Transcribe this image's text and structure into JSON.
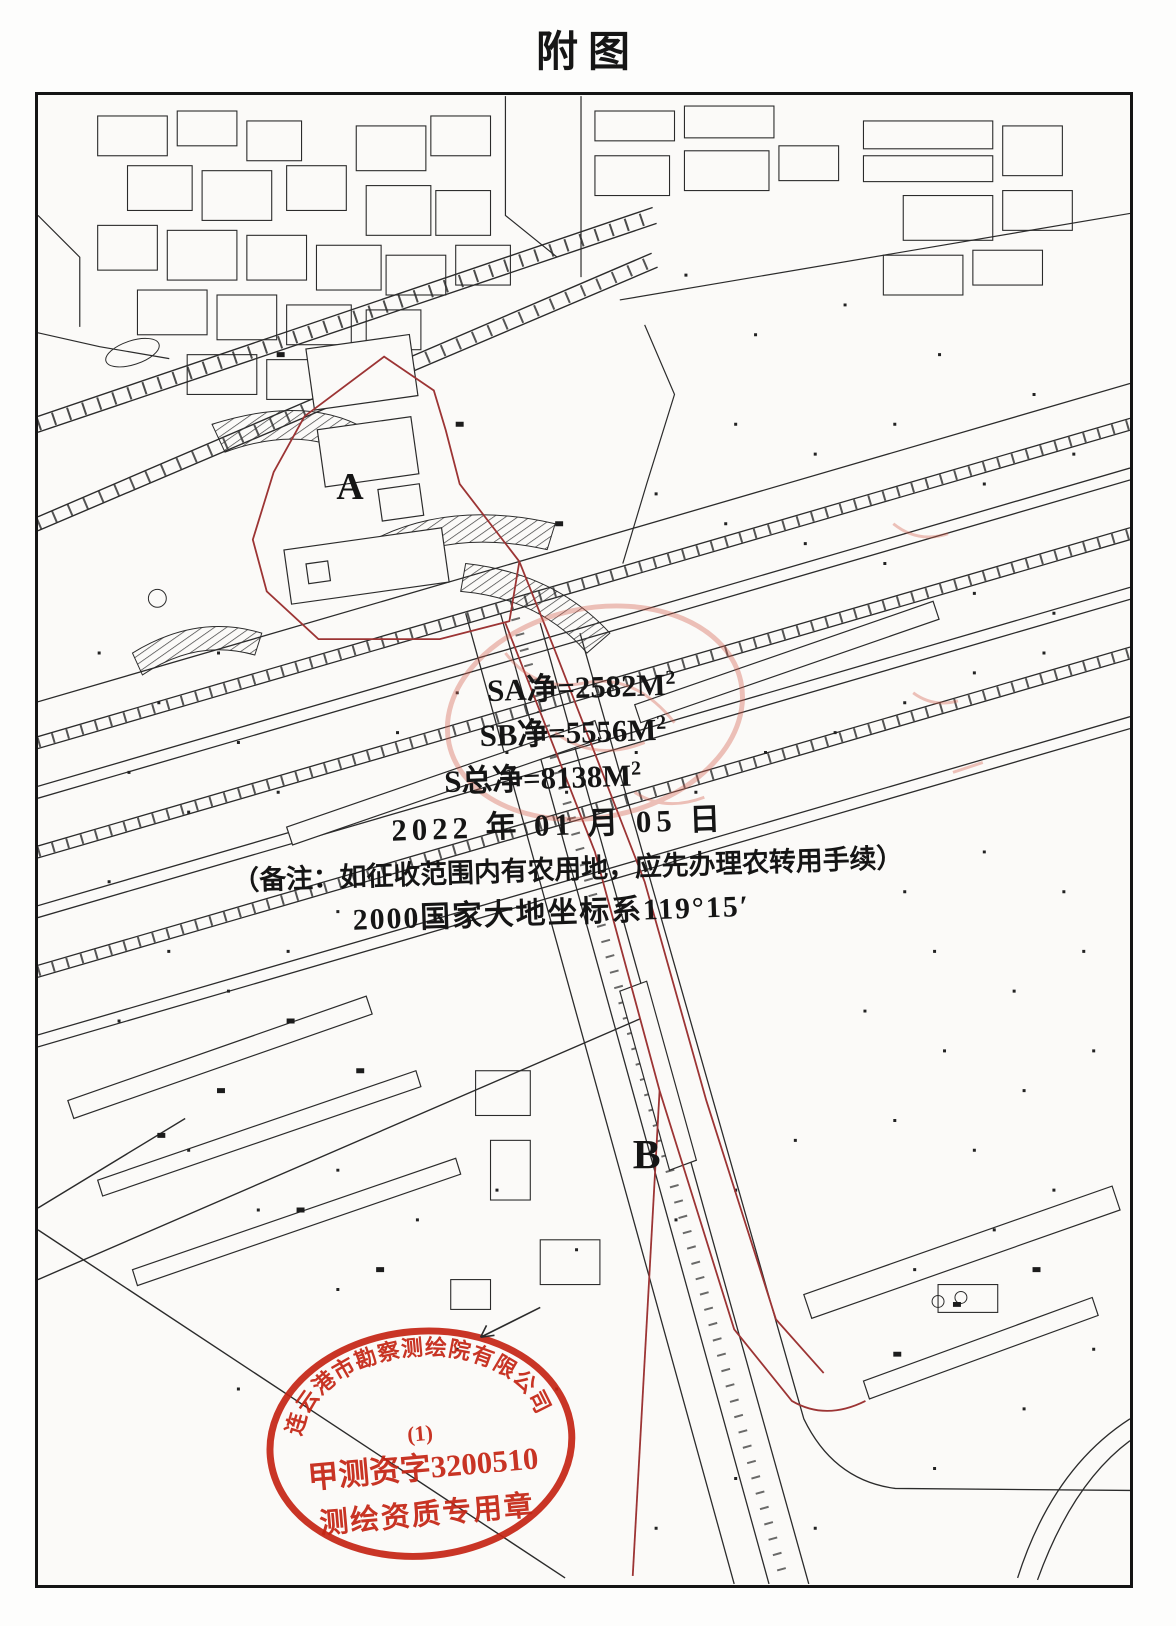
{
  "page": {
    "title": "附图"
  },
  "annotations": {
    "sa": {
      "text": "SA净=2582M",
      "sup": "2"
    },
    "sb": {
      "text": "SB净=5556M",
      "sup": "2"
    },
    "s_total": {
      "text": "S总净=8138M",
      "sup": "2"
    },
    "date": "2022 年 01 月 05 日",
    "note": "（备注：如征收范围内有农用地，应先办理农转用手续）",
    "datum": "2000国家大地坐标系119°15′"
  },
  "parcels": {
    "a_label": "A",
    "b_label": "B"
  },
  "stamp": {
    "company": "连云港市勘察测绘院有限公司",
    "line2": "(1)",
    "line3": "甲测资字3200510",
    "line4": "测绘资质专用章"
  },
  "colors": {
    "boundary_red": "#9c3434",
    "stamp_red": "#c42413",
    "line_black": "#2b2b2b"
  }
}
